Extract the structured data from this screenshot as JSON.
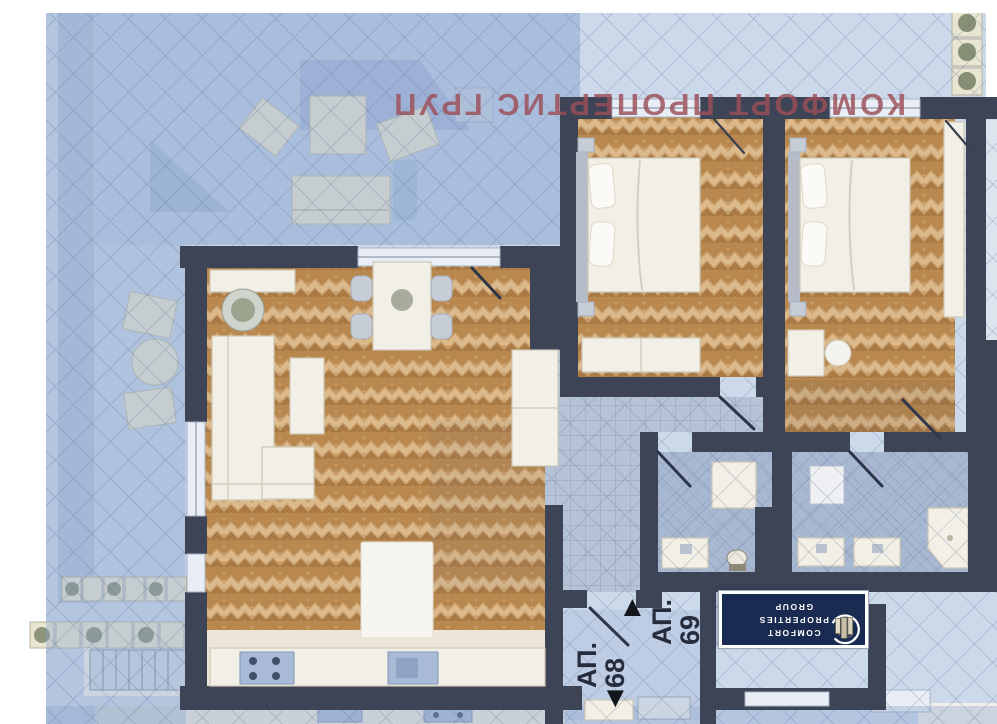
{
  "watermark": {
    "text": "КОМФОРТ ПРОПЕРТИС ГРУП"
  },
  "labels": {
    "apt68": {
      "prefix": "АП.",
      "number": "68"
    },
    "apt69": {
      "prefix": "АП.",
      "number": "69"
    }
  },
  "icons": {
    "arrow_down": "▼",
    "arrow_up": "▲"
  },
  "logo": {
    "lines": [
      "COMFORT",
      "PROPERTIES",
      "GROUP"
    ]
  },
  "colors": {
    "wall": "#3d4456",
    "watermark": "#9c4f58",
    "label": "#262c3c",
    "logoBg": "#1a2b52",
    "parquet": "#c89e6d",
    "parquetMid": "#b8884f",
    "parquetLight": "#dcb98a",
    "parquetDark": "#aa7a45",
    "tile": "#b6c3d7",
    "bathTile": "#a9b8d2",
    "hatch": "rgba(85,105,140,0.40)",
    "bg": "#ccd9ea"
  }
}
